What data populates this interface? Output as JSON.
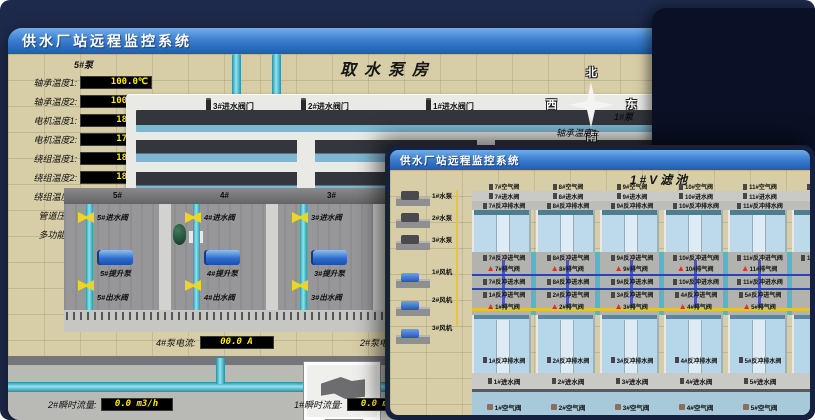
{
  "back_window": {
    "title": "供水厂站远程监控系统",
    "scene_title": "取水泵房",
    "panel": {
      "header": "5#泵",
      "readings": [
        {
          "label": "轴承温度1:",
          "value": "100.0℃"
        },
        {
          "label": "轴承温度2:",
          "value": "100.0℃"
        },
        {
          "label": "电机温度1:",
          "value": "18.1℃"
        },
        {
          "label": "电机温度2:",
          "value": "17.9℃"
        },
        {
          "label": "绕组温度1:",
          "value": "18.0℃"
        },
        {
          "label": "绕组温度2:",
          "value": "18.1℃"
        },
        {
          "label": "绕组温度3:",
          "value": "18.1℃"
        },
        {
          "label": "管道压力:",
          "value": "0.0007MPa"
        },
        {
          "label": "多功能阀:",
          "value": "0%"
        }
      ]
    },
    "right_panel": {
      "header": "1#泵",
      "labels": [
        "轴承温度1:",
        "轴承温度2:"
      ]
    },
    "intake_valves": [
      "3#进水阀门",
      "2#进水阀门",
      "1#进水阀门"
    ],
    "compass": {
      "north": "北",
      "south": "南",
      "west": "西",
      "east": "东"
    },
    "pump_hall": {
      "bays": [
        {
          "no": "5#",
          "inlet": "5#进水阀",
          "pump": "5#提升泵",
          "outlet": "5#出水阀"
        },
        {
          "no": "4#",
          "inlet": "4#进水阀",
          "pump": "4#提升泵",
          "outlet": "4#出水阀"
        },
        {
          "no": "3#",
          "inlet": "3#进水阀",
          "pump": "3#提升泵",
          "outlet": "3#出水阀"
        },
        {
          "no": "2#",
          "inlet": "2#进水阀",
          "pump": "2#提升泵",
          "outlet": "2#出水阀"
        }
      ]
    },
    "currents": [
      {
        "label": "4#泵电流:",
        "value": "00.0 A"
      },
      {
        "label": "2#泵电流:",
        "value": ""
      }
    ],
    "flows": [
      {
        "label": "2#瞬时流量:",
        "value": "0.0 m3/h"
      },
      {
        "label": "1#瞬时流量:",
        "value": "0.0 m3/h"
      }
    ]
  },
  "front_window": {
    "title": "供水厂站远程监控系统",
    "scene_title": "1#V滤池",
    "equipment": [
      {
        "label": "1#水泵"
      },
      {
        "label": "2#水泵"
      },
      {
        "label": "3#水泵"
      },
      {
        "label": "1#风机"
      },
      {
        "label": "2#风机"
      },
      {
        "label": "3#风机"
      }
    ],
    "top_air_valves": [
      "7#空气阀",
      "8#空气阀",
      "9#空气阀",
      "10#空气阀",
      "11#空气阀",
      "12#空气阀"
    ],
    "top_inlet_valves": [
      "7#进水阀",
      "8#进水阀",
      "9#进水阀",
      "10#进水阀",
      "11#进水阀"
    ],
    "top_backwash_drain": [
      "7#反冲排水阀",
      "8#反冲排水阀",
      "9#反冲排水阀",
      "10#反冲排水阀",
      "11#反冲排水阀"
    ],
    "mid_backwash_air": [
      "7#反冲进气阀",
      "8#反冲进气阀",
      "9#反冲进气阀",
      "10#反冲进气阀",
      "11#反冲进气阀",
      "12#反冲进气阀"
    ],
    "mid_exhaust": [
      "7#排气阀",
      "8#排气阀",
      "9#排气阀",
      "10#排气阀",
      "11#排气阀"
    ],
    "mid_backwash_water": [
      "7#反冲进水阀",
      "8#反冲进水阀",
      "9#反冲进水阀",
      "10#反冲进水阀",
      "11#反冲进水阀"
    ],
    "low_backwash_air": [
      "1#反冲进气阀",
      "2#反冲进气阀",
      "3#反冲进气阀",
      "4#反冲进气阀",
      "5#反冲进气阀"
    ],
    "low_exhaust": [
      "1#排气阀",
      "2#排气阀",
      "3#排气阀",
      "4#排气阀",
      "5#排气阀"
    ],
    "low_backwash_drain": [
      "1#反冲排水阀",
      "2#反冲排水阀",
      "3#反冲排水阀",
      "4#反冲排水阀",
      "5#反冲排水阀"
    ],
    "bottom_inlet_valves": [
      "1#进水阀",
      "2#进水阀",
      "3#进水阀",
      "4#进水阀",
      "5#进水阀"
    ],
    "bottom_air_valves": [
      "1#空气阀",
      "2#空气阀",
      "3#空气阀",
      "4#空气阀",
      "5#空气阀"
    ]
  },
  "colors": {
    "accent_value": "#ffee00",
    "titlebar_blue": "#2e6cc0",
    "alarm_red": "#e03020",
    "pipe_teal": "#4ab6cc",
    "pipe_yellow": "#e2c93a"
  }
}
